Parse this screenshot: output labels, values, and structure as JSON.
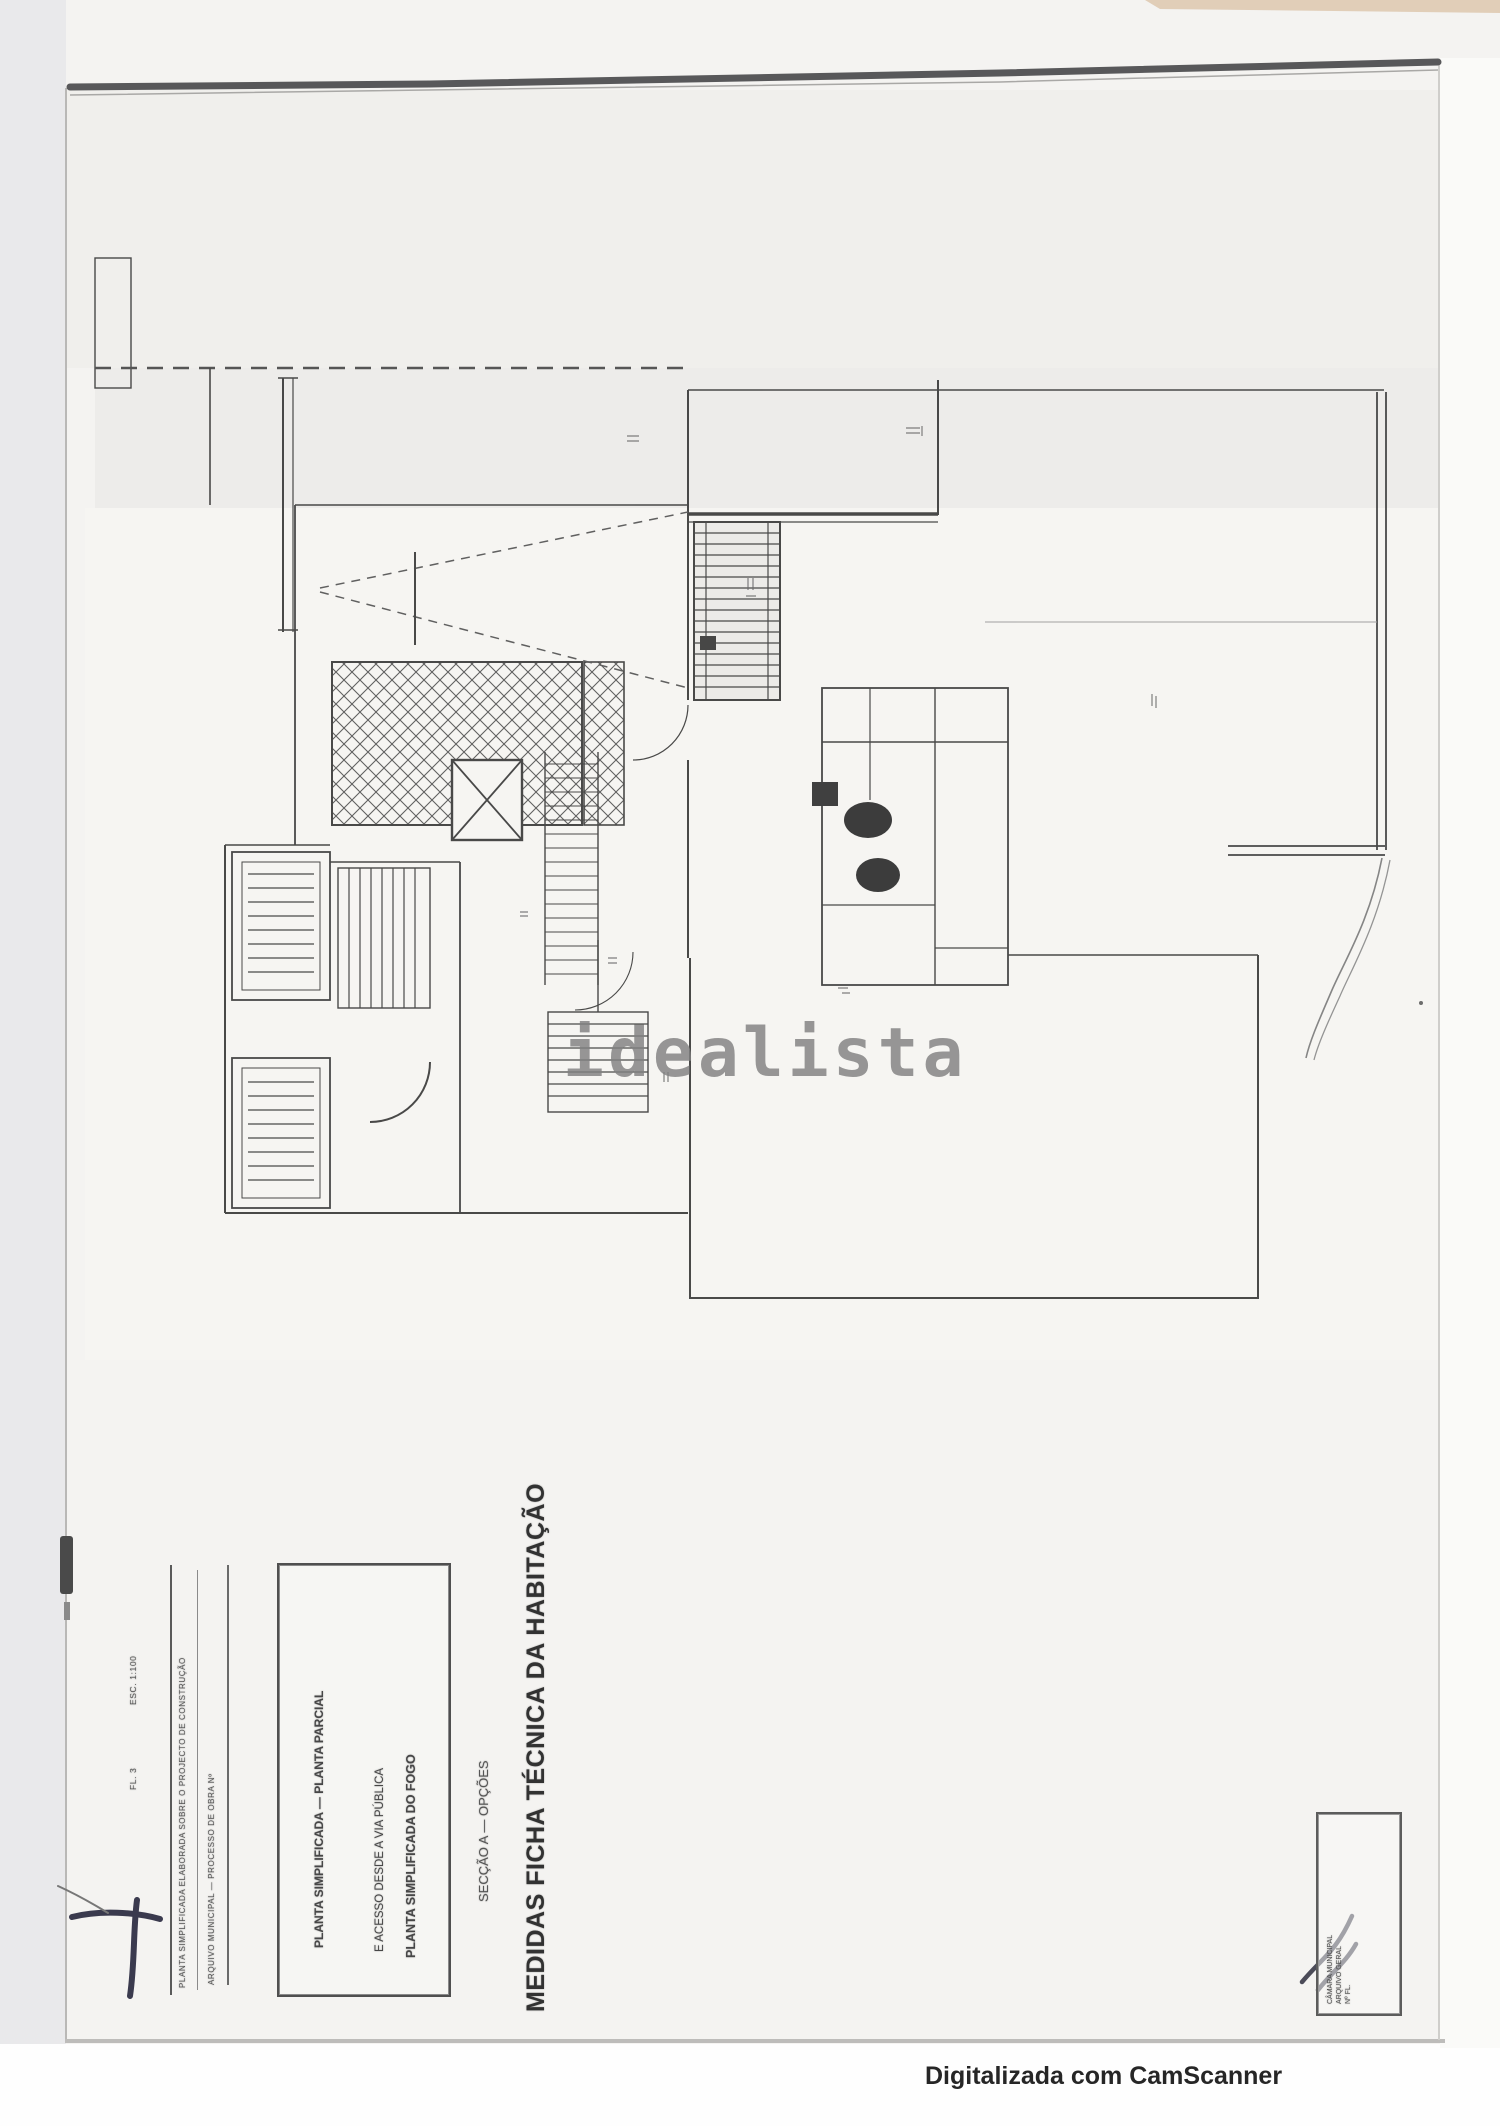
{
  "page": {
    "watermark": "idealista",
    "scanner_credit": "Digitalizada com CamScanner"
  },
  "title_block": {
    "main_title": "MEDIDAS FICHA TÉCNICA DA HABITAÇÃO",
    "subtitle": "SECÇÃO A — OPÇÕES",
    "box_lines": [
      "PLANTA SIMPLIFICADA DO FOGO",
      "E ACESSO DESDE A VIA PÚBLICA",
      "PLANTA SIMPLIFICADA — PLANTA PARCIAL"
    ],
    "side_notes": [
      "PLANTA SIMPLIFICADA ELABORADA SOBRE O PROJECTO DE CONSTRUÇÃO",
      "ARQUIVO MUNICIPAL — PROCESSO DE OBRA Nº"
    ],
    "margin_notes": [
      "ESC. 1:100",
      "FL. 3"
    ]
  },
  "stamp": {
    "lines": [
      "CÂMARA MUNICIPAL",
      "ARQUIVO GERAL",
      "Nº",
      "FL."
    ]
  },
  "colors": {
    "ink": "#3c3c3c",
    "fold_line": "#58585a",
    "watermark_gray": "#808080",
    "paper": "#f4f3f1"
  }
}
